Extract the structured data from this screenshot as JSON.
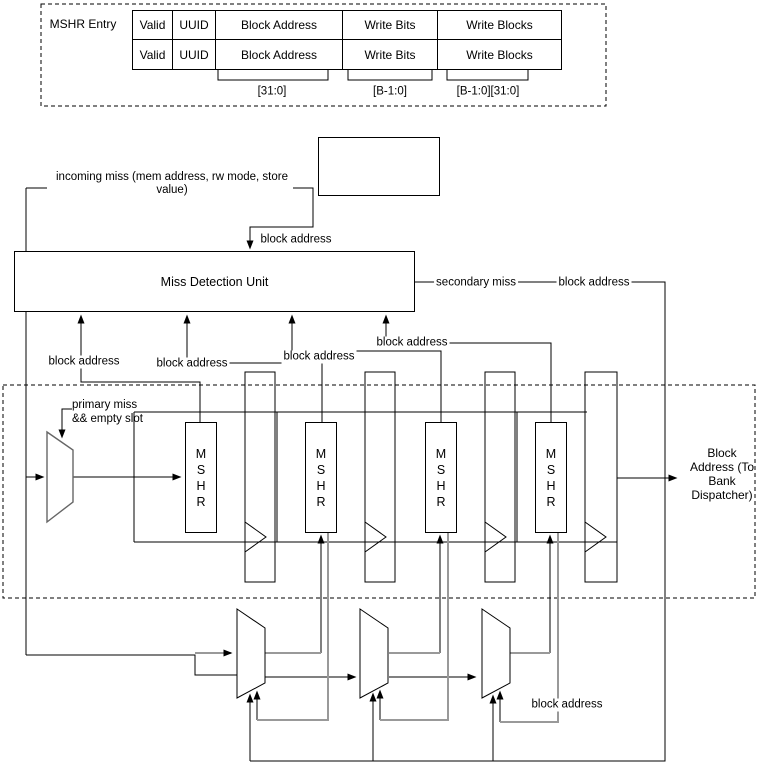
{
  "entry_table": {
    "label": "MSHR Entry",
    "rows": [
      [
        "Valid",
        "UUID",
        "Block Address",
        "Write Bits",
        "Write Blocks"
      ],
      [
        "Valid",
        "UUID",
        "Block Address",
        "Write Bits",
        "Write Blocks"
      ]
    ],
    "bit_ranges": [
      "[31:0]",
      "[B-1:0]",
      "[B-1:0][31:0]"
    ]
  },
  "labels": {
    "incoming_miss": "incoming miss (mem address, rw mode, store value)",
    "block_address": "block address",
    "secondary_miss": "secondary miss",
    "primary_miss": "primary miss\n&& empty slot",
    "output_block_address": "Block Address (To Bank Dispatcher)"
  },
  "units": {
    "miss_detection": "Miss Detection Unit",
    "mshr": "MSHR"
  },
  "colors": {
    "line": "#000000",
    "gray_line": "#999999",
    "mux_stroke": "#666666",
    "background": "#ffffff"
  }
}
